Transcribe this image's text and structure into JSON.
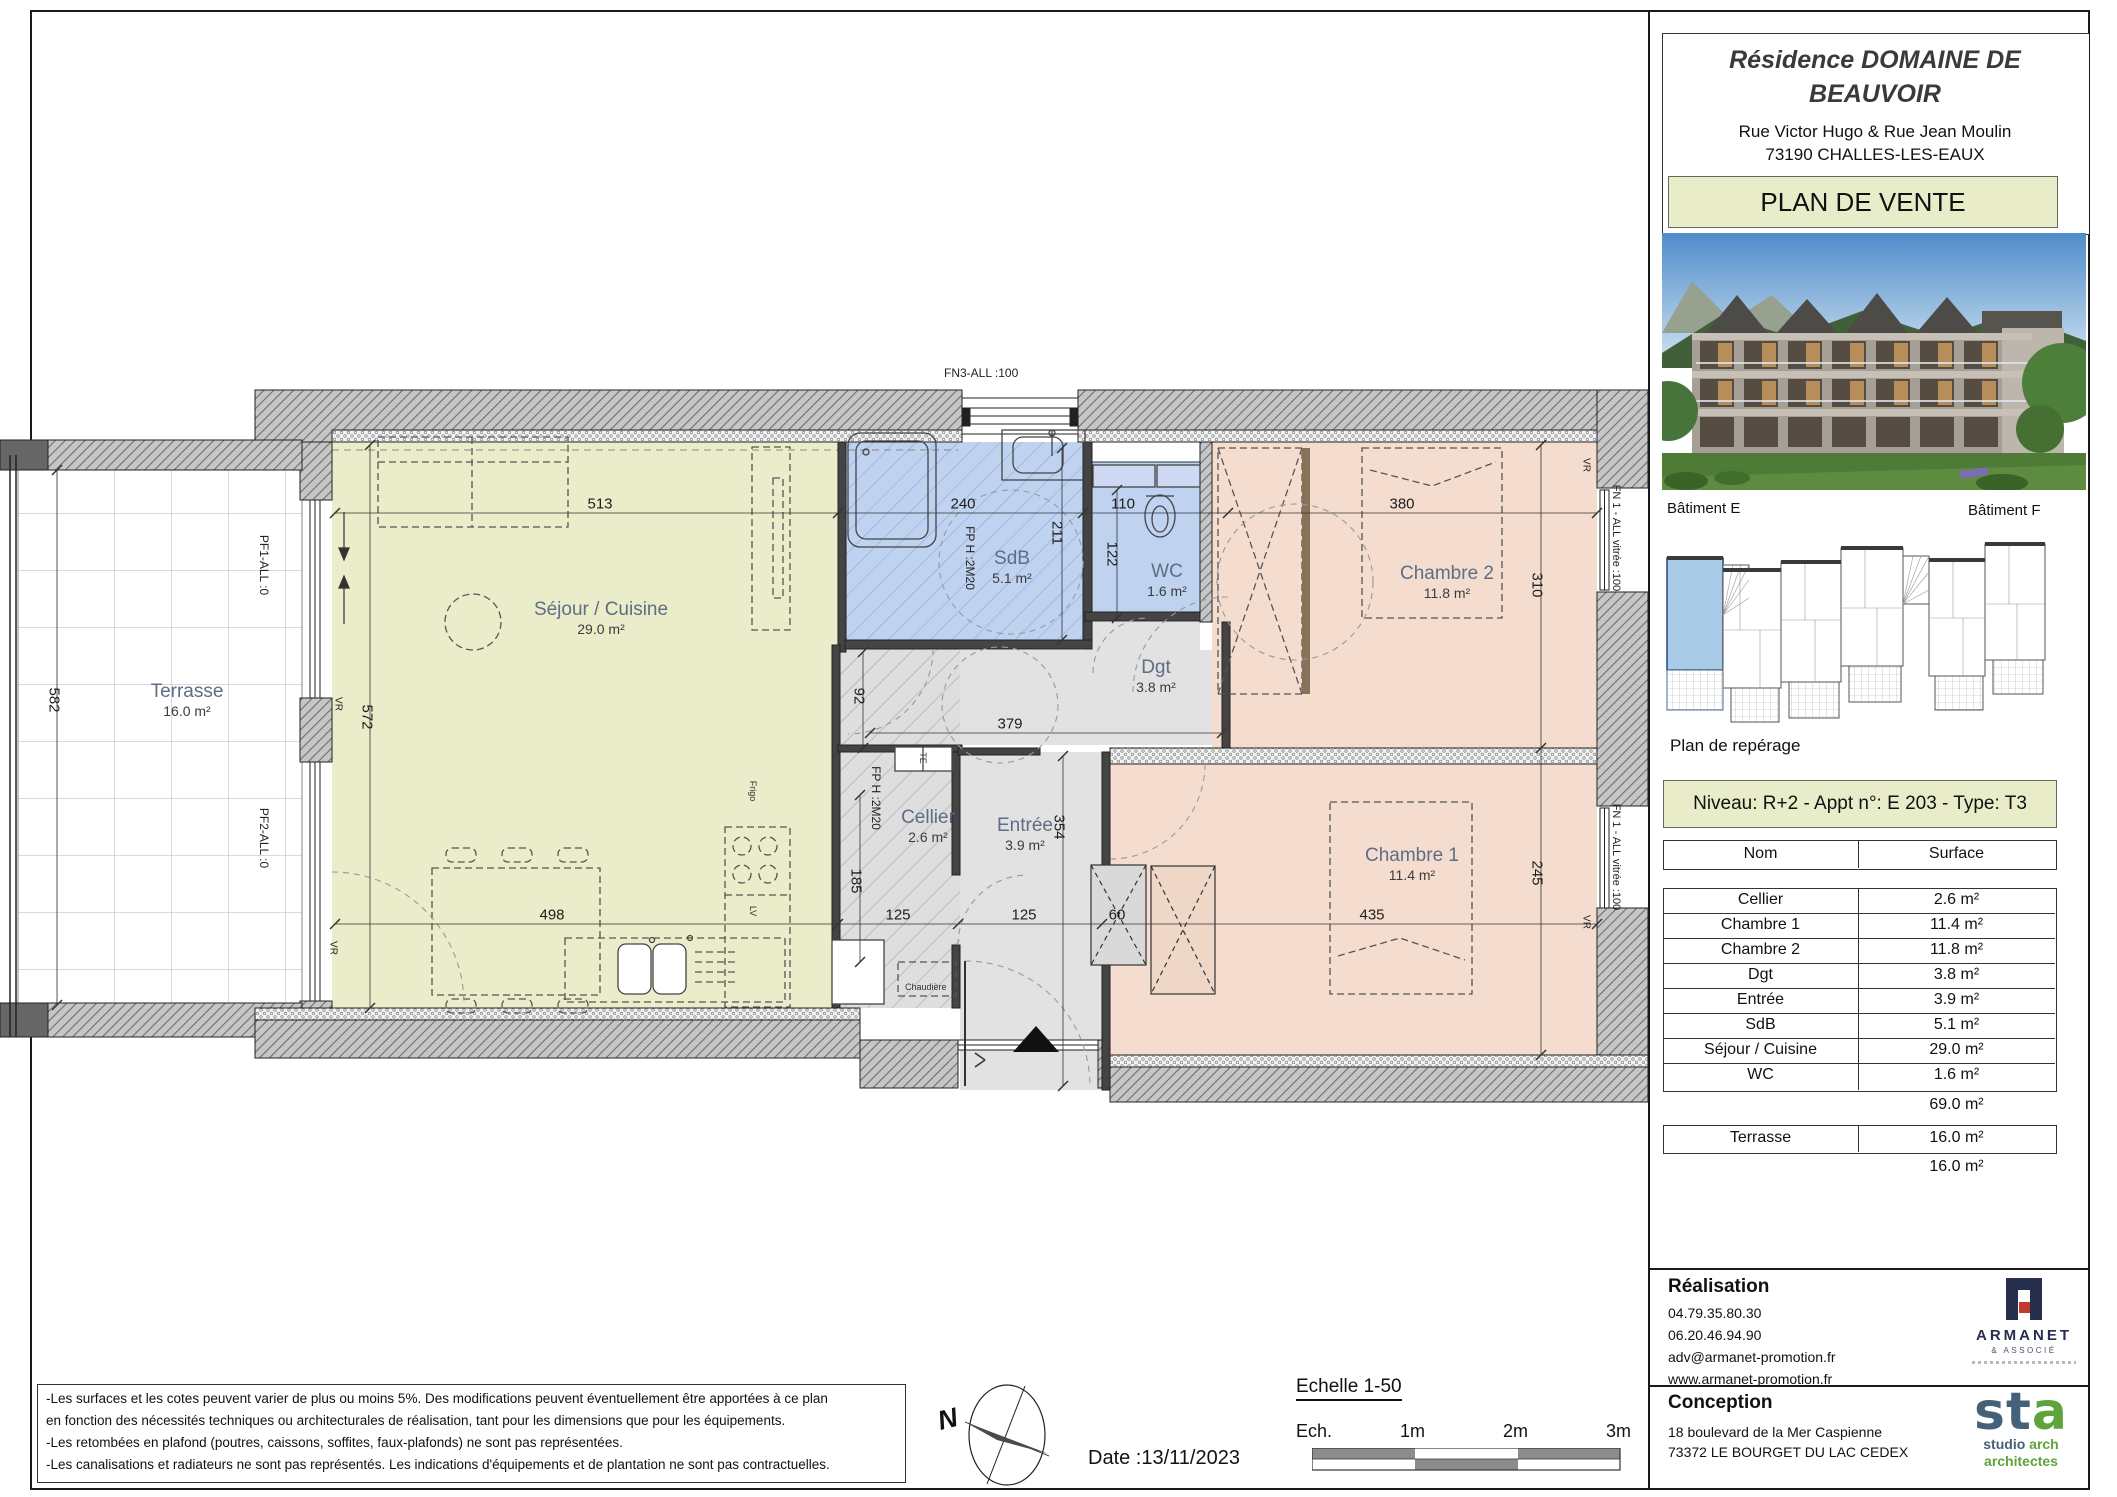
{
  "title_block": {
    "title_line1": "Résidence DOMAINE DE",
    "title_line2": "BEAUVOIR",
    "address_line1": "Rue Victor Hugo & Rue Jean Moulin",
    "address_line2": "73190 CHALLES-LES-EAUX",
    "banner": "PLAN DE VENTE"
  },
  "locator": {
    "batiment_e": "Bâtiment E",
    "batiment_f": "Bâtiment F",
    "caption": "Plan de repérage"
  },
  "unit_banner": "Niveau: R+2  - Appt n°: E 203 - Type: T3",
  "surface_table": {
    "col_name": "Nom",
    "col_surface": "Surface",
    "rows": [
      {
        "name": "Cellier",
        "surface": "2.6 m²"
      },
      {
        "name": "Chambre 1",
        "surface": "11.4 m²"
      },
      {
        "name": "Chambre 2",
        "surface": "11.8 m²"
      },
      {
        "name": "Dgt",
        "surface": "3.8 m²"
      },
      {
        "name": "Entrée",
        "surface": "3.9 m²"
      },
      {
        "name": "SdB",
        "surface": "5.1 m²"
      },
      {
        "name": "Séjour / Cuisine",
        "surface": "29.0 m²"
      },
      {
        "name": "WC",
        "surface": "1.6 m²"
      }
    ],
    "total": "69.0 m²",
    "terrasse": {
      "name": "Terrasse",
      "surface": "16.0 m²"
    },
    "terrasse_total": "16.0 m²"
  },
  "realisation": {
    "heading": "Réalisation",
    "phone1": "04.79.35.80.30",
    "phone2": "06.20.46.94.90",
    "email": "adv@armanet-promotion.fr",
    "website": "www.armanet-promotion.fr",
    "logo_name": "ARMANET",
    "logo_sub": "& ASSOCIÉ"
  },
  "conception": {
    "heading": "Conception",
    "address_line1": "18 boulevard de la Mer Caspienne",
    "address_line2": "73372 LE BOURGET DU LAC CEDEX",
    "logo_mark_st": "st",
    "logo_mark_a": "a",
    "logo_tag1a": "studio",
    "logo_tag1b": " arch",
    "logo_tag2": "architectes"
  },
  "notes": {
    "line1": "-Les surfaces et les cotes peuvent varier de plus ou moins 5%. Des modifications peuvent éventuellement être apportées à ce plan",
    "line2": "en fonction des nécessités techniques ou architecturales de réalisation, tant pour les dimensions que pour les équipements.",
    "line3": "-Les retombées en plafond (poutres, caissons, soffites, faux-plafonds) ne sont pas représentées.",
    "line4": "-Les canalisations et radiateurs ne sont pas représentés. Les indications d'équipements et de plantation ne sont pas contractuelles."
  },
  "footer": {
    "north": "N",
    "date": "Date :13/11/2023",
    "scale_title": "Echelle 1-50",
    "scale_label": "Ech.",
    "tick_1": "1m",
    "tick_2": "2m",
    "tick_3": "3m"
  },
  "plan": {
    "rooms": {
      "terrasse": {
        "name": "Terrasse",
        "area": "16.0 m²"
      },
      "sejour": {
        "name": "Séjour / Cuisine",
        "area": "29.0 m²"
      },
      "sdb": {
        "name": "SdB",
        "area": "5.1 m²"
      },
      "wc": {
        "name": "WC",
        "area": "1.6 m²"
      },
      "dgt": {
        "name": "Dgt",
        "area": "3.8 m²"
      },
      "chambre2": {
        "name": "Chambre 2",
        "area": "11.8 m²"
      },
      "chambre1": {
        "name": "Chambre 1",
        "area": "11.4 m²"
      },
      "cellier": {
        "name": "Cellier",
        "area": "2.6 m²"
      },
      "entree": {
        "name": "Entrée",
        "area": "3.9 m²"
      }
    },
    "dims": {
      "sejour_w": "513",
      "sdb_w": "240",
      "wc_w": "110",
      "ch2_w": "380",
      "kitchen_w": "498",
      "cellier_w": "125",
      "entree_w": "125",
      "placard_w": "60",
      "ch1_w": "435",
      "terrasse_h": "582",
      "sejour_h": "572",
      "sdb_h": "211",
      "wc_h": "122",
      "fp_strip_h": "92",
      "dgt_w": "379",
      "ch2_h": "310",
      "ch1_h": "245",
      "entree_h": "354",
      "cellier_h": "185"
    },
    "marks": {
      "fn3": "FN3-ALL :100",
      "pf1": "PF1-ALL :0",
      "pf2": "PF2-ALL :0",
      "fn1": "FN 1 - ALL vitrée :100",
      "vr": "VR",
      "fp": "FP H :2M20",
      "te": "TE",
      "frigo": "Frigo",
      "lv": "LV",
      "chaudiere": "Chaudière"
    }
  },
  "colors": {
    "khaki": "#e9ecc8",
    "sejour": "#ebecc9",
    "bedroom": "#f4ddcf",
    "bath_blue": "#bfd2f0",
    "hall_gray": "#e2e2e2",
    "highlight_unit": "#a9cbe8"
  }
}
